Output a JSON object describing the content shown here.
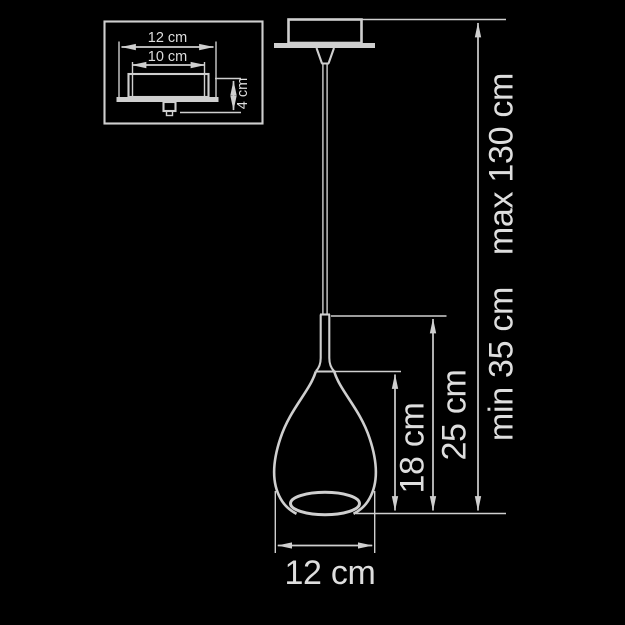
{
  "colors": {
    "background": "#000000",
    "line": "#cfcfcf",
    "text": "#dedede"
  },
  "inset": {
    "outer_width_label": "12 cm",
    "inner_width_label": "10 cm",
    "height_label": "4 cm"
  },
  "main": {
    "shade_width_label": "12 cm",
    "shade_height_label": "18 cm",
    "body_height_label": "25 cm",
    "suspension_min_label": "min 35 cm",
    "suspension_max_label": "max 130 cm"
  }
}
